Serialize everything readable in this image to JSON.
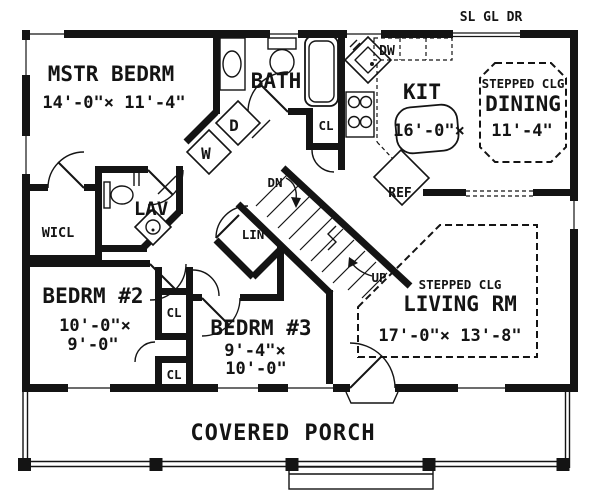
{
  "colors": {
    "ink": "#141414",
    "paper": "#ffffff"
  },
  "annotations": {
    "slider": "SL GL DR",
    "down": "DN",
    "up": "UP"
  },
  "rooms": {
    "master": {
      "name": "MSTR BEDRM",
      "dims": "14'-0\"× 11'-4\""
    },
    "bath": {
      "name": "BATH"
    },
    "kitchen": {
      "name": "KIT",
      "dims": "16'-0\"×"
    },
    "dining": {
      "ceiling": "STEPPED CLG",
      "name": "DINING",
      "dims": "11'-4\""
    },
    "living": {
      "ceiling": "STEPPED CLG",
      "name": "LIVING RM",
      "dims": "17'-0\"× 13'-8\""
    },
    "bedroom2": {
      "name": "BEDRM #2",
      "dims1": "10'-0\"×",
      "dims2": "9'-0\""
    },
    "bedroom3": {
      "name": "BEDRM #3",
      "dims1": "9'-4\"×",
      "dims2": "10'-0\""
    },
    "wicl": {
      "name": "WICL"
    },
    "lav": {
      "name": "LAV"
    },
    "porch": {
      "name": "COVERED PORCH"
    }
  },
  "fixtures": {
    "washer": "W",
    "dryer": "D",
    "dishwasher": "DW",
    "refrigerator": "REF",
    "linen": "LIN",
    "closet": "CL"
  }
}
